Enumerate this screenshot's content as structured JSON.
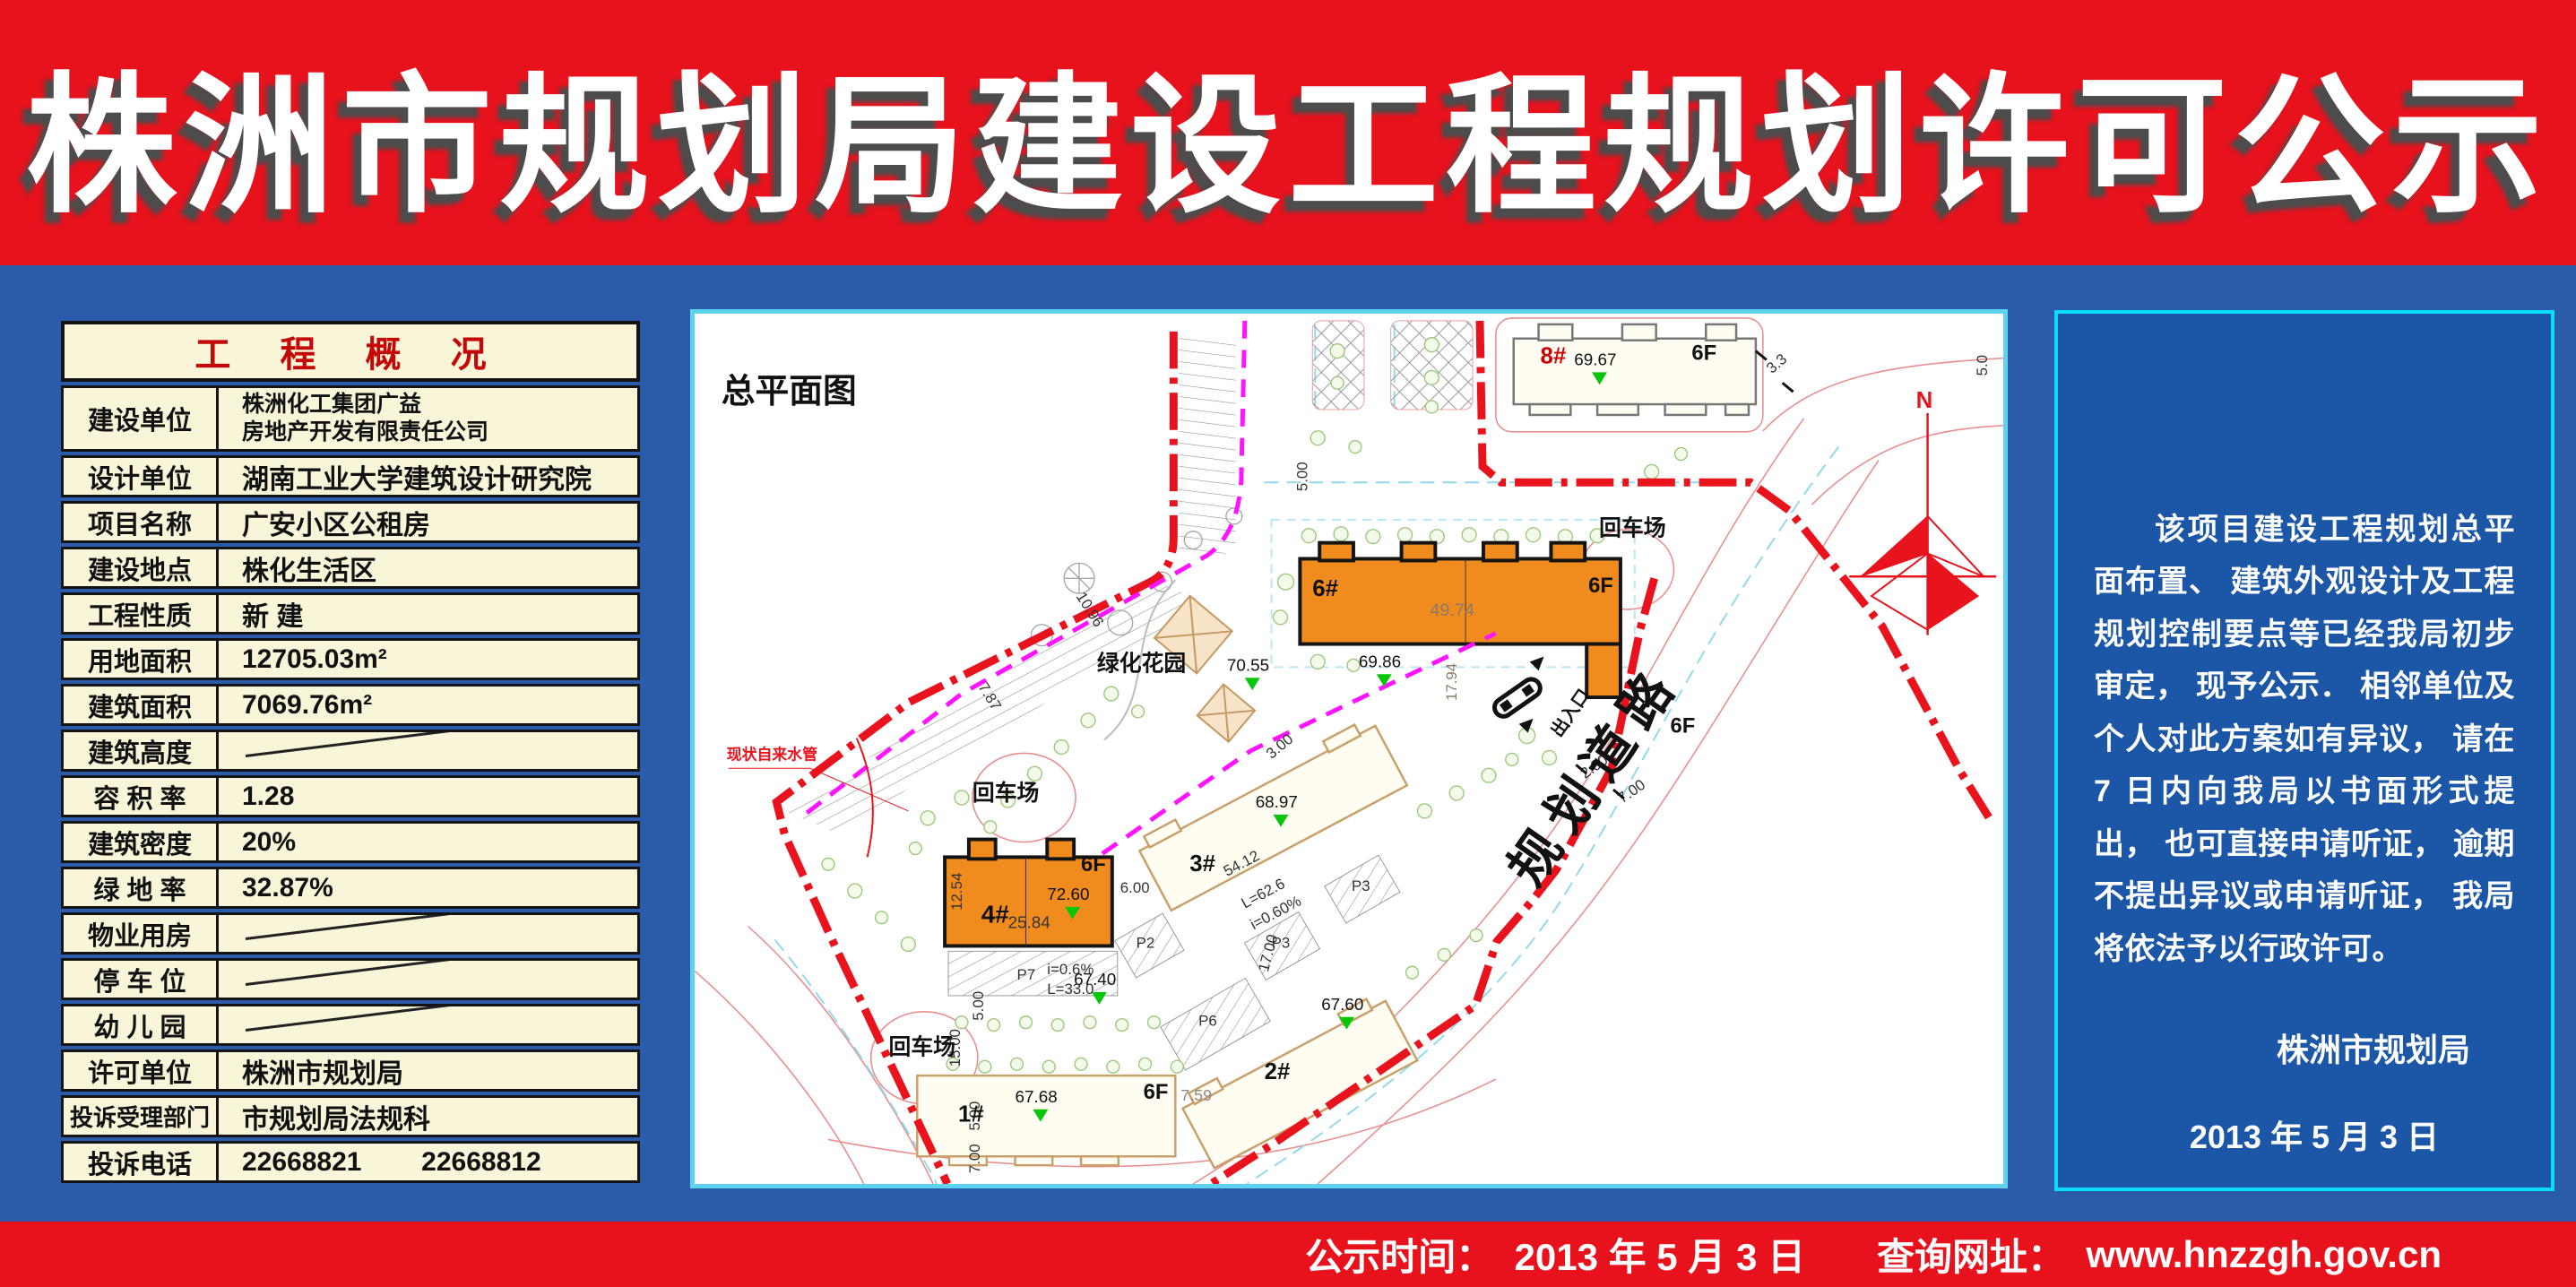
{
  "header": {
    "title": "株洲市规划局建设工程规划许可公示"
  },
  "overview_table": {
    "title": "工 程 概 况",
    "rows": [
      {
        "label": "建设单位",
        "value": "株洲化工集团广益",
        "value2": "房地产开发有限责任公司"
      },
      {
        "label": "设计单位",
        "value": "湖南工业大学建筑设计研究院"
      },
      {
        "label": "项目名称",
        "value": "广安小区公租房"
      },
      {
        "label": "建设地点",
        "value": "株化生活区"
      },
      {
        "label": "工程性质",
        "value": "新 建"
      },
      {
        "label": "用地面积",
        "value": "12705.03m²"
      },
      {
        "label": "建筑面积",
        "value": "7069.76m²"
      },
      {
        "label": "建筑高度",
        "value": ""
      },
      {
        "label": "容 积 率",
        "value": "1.28"
      },
      {
        "label": "建筑密度",
        "value": "20%"
      },
      {
        "label": "绿 地 率",
        "value": "32.87%"
      },
      {
        "label": "物业用房",
        "value": ""
      },
      {
        "label": "停 车 位",
        "value": ""
      },
      {
        "label": "幼 儿 园",
        "value": ""
      },
      {
        "label": "许可单位",
        "value": "株洲市规划局"
      },
      {
        "label": "投诉受理部门",
        "value": "市规划局法规科"
      },
      {
        "label": "投诉电话",
        "value": "22668821        22668812"
      }
    ]
  },
  "site_plan": {
    "title": "总平面图",
    "buildings": {
      "b1": "1#",
      "b2": "2#",
      "b3": "3#",
      "b4": "4#",
      "b6": "6#",
      "b8": "8#"
    },
    "floor": "6F",
    "turnaround": "回车场",
    "garden": "绿化花园",
    "entrance": "出入口",
    "road": "规划道路",
    "water_pipe": "现状自来水管",
    "north": "N",
    "parking": {
      "p2": "P2",
      "p3": "P3",
      "p6": "P6",
      "p7": "P7"
    },
    "elev": {
      "e1": "69.67",
      "e2": "70.55",
      "e3": "69.86",
      "e4": "68.97",
      "e5": "72.60",
      "e6": "67.40",
      "e7": "67.60",
      "e8": "67.68"
    },
    "dims": {
      "d1": "49.74",
      "d2": "17.94",
      "d3": "12.54",
      "d4": "25.84",
      "d5": "54.12",
      "d6": "6.00",
      "d7": "5.00",
      "d8": "7.00",
      "d9": "15.00",
      "d10": "3.3",
      "d11": "2.00",
      "d12": "7.59",
      "d13": "L=62.6",
      "d14": "i=0.60%",
      "d15": "17.00",
      "d16": "i=0.6%",
      "d17": "L=33.0",
      "d18": "10.96",
      "d19": "7.87",
      "d20": "5.0",
      "d21": "3.00"
    }
  },
  "notice": {
    "paragraph": "该项目建设工程规划总平面布置、 建筑外观设计及工程规划控制要点等已经我局初步审定， 现予公示． 相邻单位及个人对此方案如有异议， 请在 7 日内向我局以书面形式提出， 也可直接申请听证， 逾期不提出异议或申请听证， 我局将依法予以行政许可。",
    "signature": "株洲市规划局",
    "date": "2013 年 5 月 3 日"
  },
  "footer": {
    "time_label": "公示时间：  ",
    "time_value": "2013 年 5 月 3 日",
    "site_label": "查询网址：  ",
    "site_value": "www.hnzzgh.gov.cn"
  },
  "colors": {
    "banner_red": "#e8121d",
    "body_blue": "#2b5cab",
    "panel_blue": "#1b56a7",
    "cyan_border": "#0adcfc",
    "table_cream": "#f9f5d8",
    "building_orange": "#f08c1e",
    "boundary_red": "#e8131c",
    "boundary_magenta": "#ff14ff"
  }
}
